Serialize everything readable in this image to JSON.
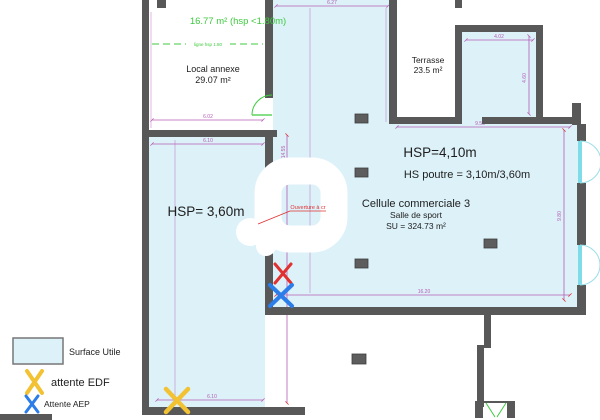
{
  "plan": {
    "local_annexe": {
      "attic_note": "16.77 m² (hsp <1.80m)",
      "hsp_line_label": "ligne hsp 1.80",
      "label": "Local annexe",
      "area": "29.07 m²"
    },
    "left_room": {
      "hsp": "HSP= 3,60m"
    },
    "main_room": {
      "hsp": "HSP=4,10m",
      "beam": "HS poutre = 3,10m/3,60m",
      "title": "Cellule commerciale 3",
      "subtitle": "Salle de sport",
      "surface": "SU = 324.73 m²"
    },
    "terrasse": {
      "label": "Terrasse",
      "area": "23.5 m²"
    },
    "opening_note": "Ouverture à cr"
  },
  "dimensions": {
    "annexe_width": "6.02",
    "left_room_width_top": "6.10",
    "left_room_width_bottom": "6.10",
    "left_room_height": "14.55",
    "main_room_width_top": "6.27",
    "main_room_width_bottom": "16.20",
    "main_room_height_right": "9.80",
    "top_right_room_width": "4.02",
    "top_right_room_height": "4.60",
    "terrace_row_width": "9.55"
  },
  "legend": {
    "surface_utile": "Surface Utile",
    "attente_edf": "attente EDF",
    "attente_aep": "Attente AEP"
  },
  "colors": {
    "surface_fill": "#dcf1f8",
    "wall": "#585858",
    "dimension": "#b55cb5",
    "annotation_green": "#3fca3f",
    "annotation_red": "#e03030",
    "edf_yellow": "#f2c233",
    "aep_blue": "#2b7de9",
    "window_cyan": "#7ddce8"
  }
}
